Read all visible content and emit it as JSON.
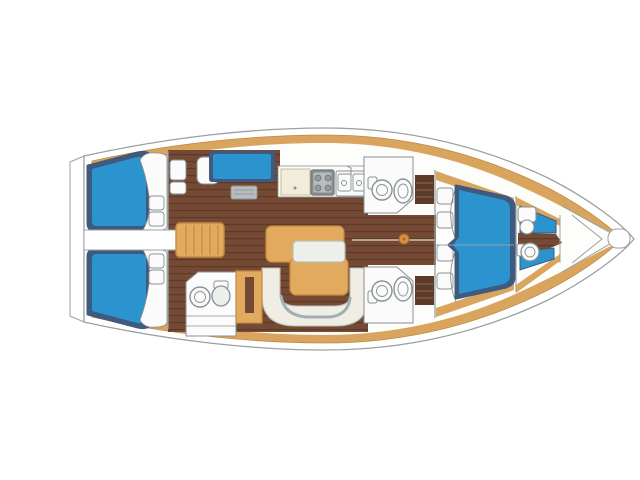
{
  "diagram": {
    "title": "sailing-yacht-interior-deck-plan",
    "view": "top-down, bow pointing right",
    "areas": [
      {
        "name": "swim-platform"
      },
      {
        "name": "aft-cabin-port",
        "berth": "double"
      },
      {
        "name": "aft-cabin-starboard",
        "berth": "double"
      },
      {
        "name": "engine-compartment"
      },
      {
        "name": "companionway-steps"
      },
      {
        "name": "nav-station"
      },
      {
        "name": "galley",
        "fixtures": [
          "counter",
          "stove",
          "double-sink"
        ]
      },
      {
        "name": "aft-head",
        "fixtures": [
          "sink",
          "toilet"
        ]
      },
      {
        "name": "saloon",
        "fixtures": [
          "table",
          "u-settee"
        ]
      },
      {
        "name": "mid-head-port",
        "fixtures": [
          "toilet",
          "sink"
        ]
      },
      {
        "name": "mid-head-starboard",
        "fixtures": [
          "toilet",
          "sink"
        ]
      },
      {
        "name": "mast"
      },
      {
        "name": "forward-cabin",
        "berth": "v-double"
      },
      {
        "name": "forward-head",
        "fixtures": [
          "sink",
          "toilet"
        ]
      },
      {
        "name": "anchor-locker"
      }
    ]
  },
  "colors": {
    "bg": "#ffffff",
    "hull_line": "#9aa2a0",
    "deck_tan": "#d9a55e",
    "deck_tan_edge": "#c08b45",
    "interior_white": "#fdfdfb",
    "berth_navy": "#3e5a7e",
    "berth_blue": "#2b93ce",
    "floor_brown": "#744a34",
    "floor_line": "#5e3926",
    "cabinet_dark": "#5c3b2b",
    "cabinet_line": "#8a6a50",
    "furniture_tan": "#e2aa5f",
    "furniture_tan_edge": "#c68a3f",
    "counter_cream": "#f2ecda",
    "counter_cream_edge": "#c9bd9c",
    "fixture_white": "#fafbfa",
    "fixture_line": "#8a9194",
    "stove_gray": "#96999b",
    "stove_gray_dark": "#6e7476",
    "stove_gray_light": "#b7bcbe",
    "settee_fill": "#f0eee4",
    "settee_edge": "#b9bdb6",
    "settee_trim": "#9fb0b4",
    "leaf_white": "#edefea",
    "mast_orange": "#d79144",
    "mast_edge": "#a86a2c",
    "seam_light": "#cfc4b4",
    "centerline_blue": "#8fa3b8"
  }
}
